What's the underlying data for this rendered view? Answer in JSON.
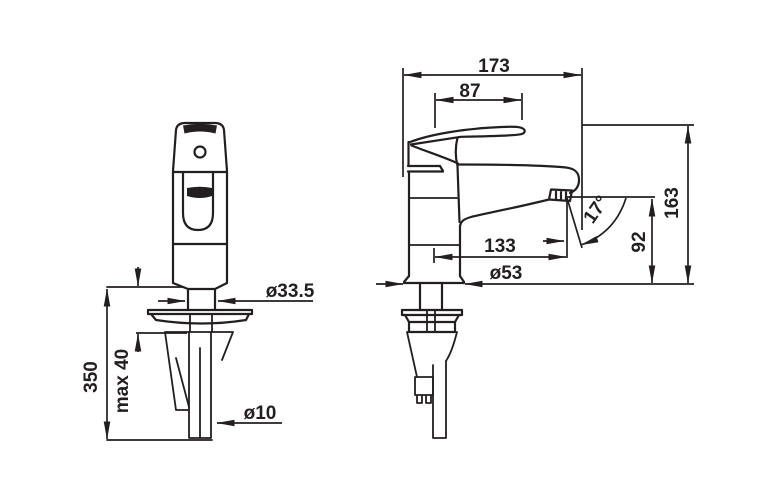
{
  "colors": {
    "line": "#231f20",
    "background": "#ffffff"
  },
  "front_view": {
    "dims": {
      "hole_diameter": "ø33.5",
      "supply_pipe_length": "350",
      "max_mounting_thickness": "max 40",
      "supply_pipe_diameter": "ø10"
    }
  },
  "side_view": {
    "dims": {
      "total_length": "173",
      "lever_length": "87",
      "spout_reach": "133",
      "base_diameter": "ø53",
      "spout_angle": "17°",
      "outlet_height": "92",
      "total_height": "163"
    }
  }
}
